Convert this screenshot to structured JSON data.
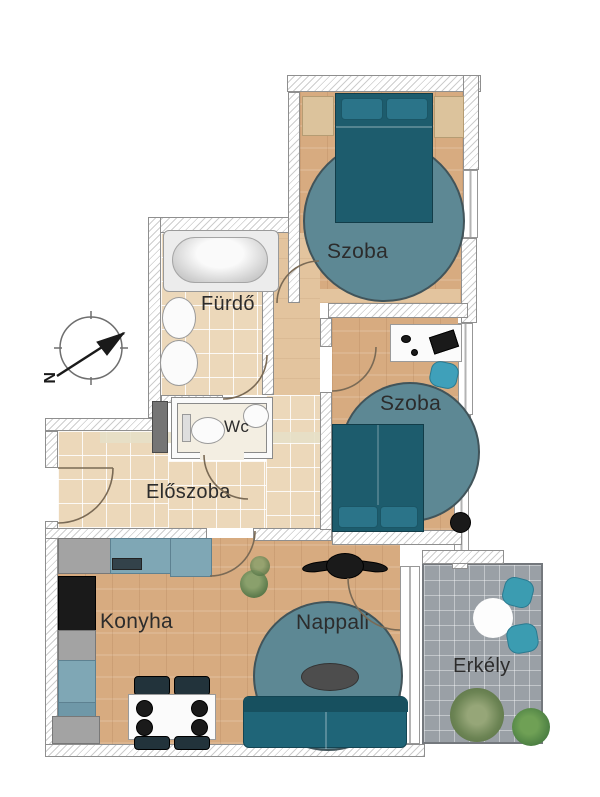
{
  "rooms": {
    "bedroom1": {
      "label": "Szoba"
    },
    "bedroom2": {
      "label": "Szoba"
    },
    "bathroom": {
      "label": "Fürdő"
    },
    "wc": {
      "label": "Wc"
    },
    "hallway": {
      "label": "Előszoba"
    },
    "kitchen": {
      "label": "Konyha"
    },
    "living": {
      "label": "Nappali"
    },
    "balcony": {
      "label": "Erkély"
    }
  },
  "compass": {
    "label": "N"
  },
  "colors": {
    "rug": "#5d8894",
    "bed": "#1d5c6d",
    "sofa": "#1f6578",
    "chair": "#3fa0ba",
    "wood": "#d7ab80",
    "wood-light": "#e3c49e",
    "tile": "#ecd8ba",
    "balcony-tile": "#9aa0a6",
    "counter": "#7fa7b5",
    "appliance-dark": "#1a1a1a",
    "label-text": "#2c2c2c"
  }
}
